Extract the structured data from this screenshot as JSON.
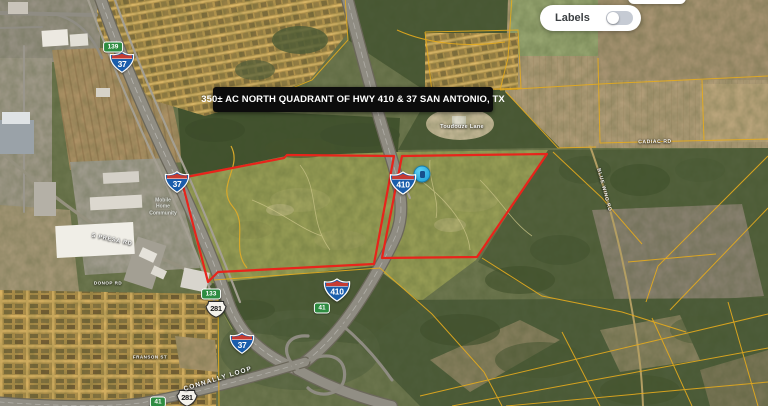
{
  "controls": {
    "labels_label": "Labels",
    "labels_state": "off"
  },
  "banner": {
    "title": "350± AC NORTH QUADRANT OF HWY 410 & 37 SAN ANTONIO, TX"
  },
  "map": {
    "colors": {
      "parcel_outline": "#e8241b",
      "parcel_lines": "#e6ab1d",
      "marker_blue": "#35c0ec",
      "banner_bg": "#0c0c0c"
    },
    "marker": {
      "x": 422,
      "y": 174
    },
    "parcels": [
      {
        "name": "west-parcel",
        "points": [
          [
            181,
            178
          ],
          [
            284,
            158
          ],
          [
            287,
            155
          ],
          [
            394,
            156
          ],
          [
            374,
            264
          ],
          [
            218,
            272
          ],
          [
            208,
            282
          ]
        ]
      },
      {
        "name": "east-parcel",
        "points": [
          [
            402,
            156
          ],
          [
            547,
            154
          ],
          [
            477,
            257
          ],
          [
            382,
            258
          ]
        ]
      }
    ],
    "shields": [
      {
        "type": "interstate",
        "num": "37",
        "x": 122,
        "y": 62
      },
      {
        "type": "interstate",
        "num": "37",
        "x": 177,
        "y": 182
      },
      {
        "type": "interstate",
        "num": "410",
        "x": 403,
        "y": 183
      },
      {
        "type": "interstate",
        "num": "410",
        "x": 337,
        "y": 290
      },
      {
        "type": "interstate",
        "num": "37",
        "x": 242,
        "y": 343
      },
      {
        "type": "us",
        "num": "281",
        "x": 216,
        "y": 309
      },
      {
        "type": "us",
        "num": "281",
        "x": 187,
        "y": 398
      },
      {
        "type": "exit",
        "num": "139",
        "x": 113,
        "y": 47
      },
      {
        "type": "exit",
        "num": "133",
        "x": 211,
        "y": 294
      },
      {
        "type": "exit",
        "num": "41",
        "x": 322,
        "y": 308
      },
      {
        "type": "exit",
        "num": "41",
        "x": 158,
        "y": 402
      }
    ],
    "road_labels": [
      {
        "text": "CONNALLY LOOP",
        "x": 218,
        "y": 379,
        "rotate": -17,
        "size": 6.5,
        "spacing": 1.2
      },
      {
        "text": "S PRESA RD",
        "x": 112,
        "y": 240,
        "rotate": 12,
        "size": 5.5,
        "spacing": 0.8
      },
      {
        "text": "CADIAC RD",
        "x": 655,
        "y": 142,
        "rotate": -1,
        "size": 5,
        "spacing": 0.6
      },
      {
        "text": "BLUE WING RD",
        "x": 604,
        "y": 190,
        "rotate": 75,
        "size": 5,
        "spacing": 0.6
      },
      {
        "text": "Toudouze Lane",
        "x": 462,
        "y": 127,
        "rotate": 0,
        "size": 5.5,
        "spacing": 0.3
      },
      {
        "text": "FRANSON ST",
        "x": 150,
        "y": 357,
        "rotate": 0,
        "size": 4.5,
        "spacing": 0.5
      },
      {
        "text": "DONOP RD",
        "x": 108,
        "y": 283,
        "rotate": 0,
        "size": 4.5,
        "spacing": 0.5
      }
    ],
    "place_labels": [
      {
        "lines": [
          "Mobile",
          "Home",
          "Community"
        ],
        "x": 163,
        "y": 207,
        "size": 5
      }
    ]
  }
}
